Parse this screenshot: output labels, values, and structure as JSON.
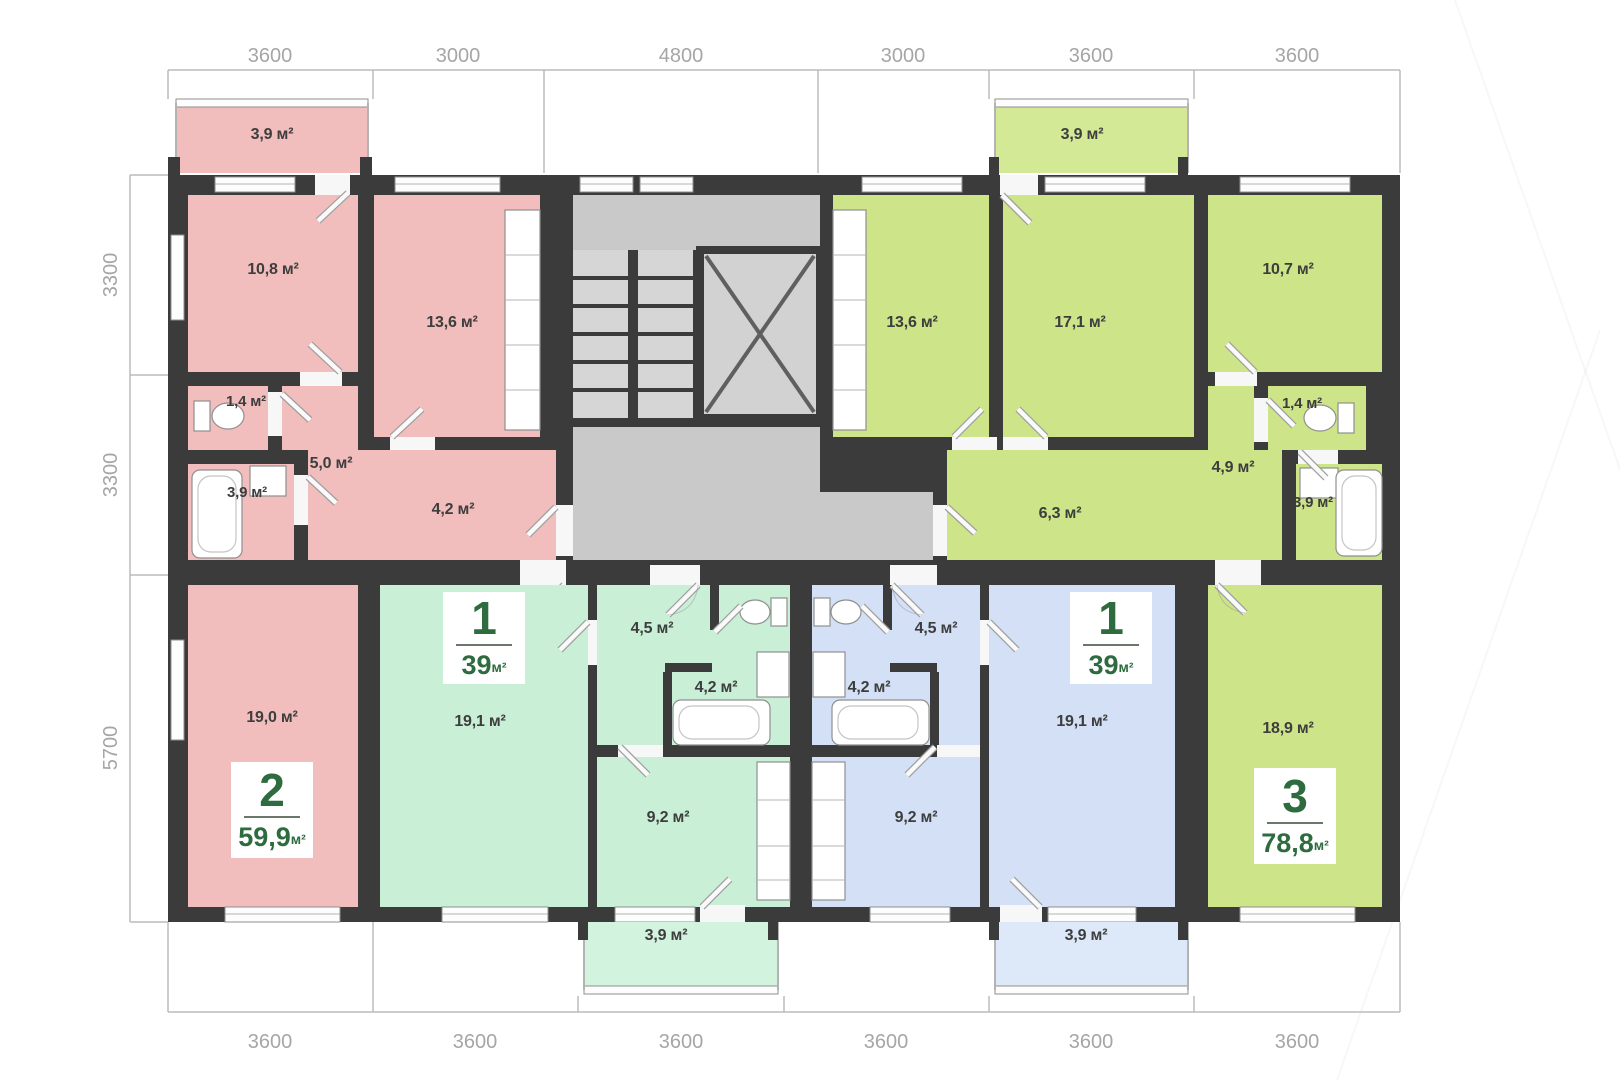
{
  "title": "Типовой этаж — план",
  "units": "м²",
  "colors": {
    "wall": "#3b3b3b",
    "core_gray": "#c9c9c9",
    "apartment_pink": "#f2bdbd",
    "apartment_mint": "#c9efd7",
    "apartment_blue": "#d3e0f5",
    "apartment_lime": "#cde489",
    "badge_green": "#2e6b3e",
    "dimension_text": "#a6a6a6"
  },
  "dimensions": {
    "top": [
      "3600",
      "3000",
      "4800",
      "3000",
      "3600",
      "3600"
    ],
    "left": [
      "3300",
      "3300",
      "5700"
    ],
    "bottom": [
      "3600",
      "3600",
      "3600",
      "3600",
      "3600",
      "3600"
    ]
  },
  "apartments": {
    "pink": {
      "badge": {
        "number": "2",
        "area": "59,9",
        "unit": "м²"
      },
      "rooms": {
        "balcony": "3,9 м²",
        "bedroom": "10,8 м²",
        "kitchen": "13,6 м²",
        "wc": "1,4 м²",
        "bathroom": "3,9 м²",
        "hall": "5,0 м²",
        "corridor": "4,2 м²",
        "living": "19,0 м²"
      }
    },
    "mint": {
      "badge": {
        "number": "1",
        "area": "39",
        "unit": "м²"
      },
      "rooms": {
        "hall": "4,5 м²",
        "bathroom": "4,2 м²",
        "kitchen": "9,2 м²",
        "living": "19,1 м²",
        "balcony": "3,9 м²"
      }
    },
    "blue": {
      "badge": {
        "number": "1",
        "area": "39",
        "unit": "м²"
      },
      "rooms": {
        "hall": "4,5 м²",
        "bathroom": "4,2 м²",
        "kitchen": "9,2 м²",
        "living": "19,1 м²",
        "balcony": "3,9 м²"
      }
    },
    "lime": {
      "badge": {
        "number": "3",
        "area": "78,8",
        "unit": "м²"
      },
      "rooms": {
        "balcony": "3,9 м²",
        "kitchen": "13,6 м²",
        "bedroom": "17,1 м²",
        "bedroom2": "10,7 м²",
        "wc": "1,4 м²",
        "hall": "4,9 м²",
        "bathroom": "3,9 м²",
        "corridor": "6,3 м²",
        "living": "18,9 м²"
      }
    }
  }
}
